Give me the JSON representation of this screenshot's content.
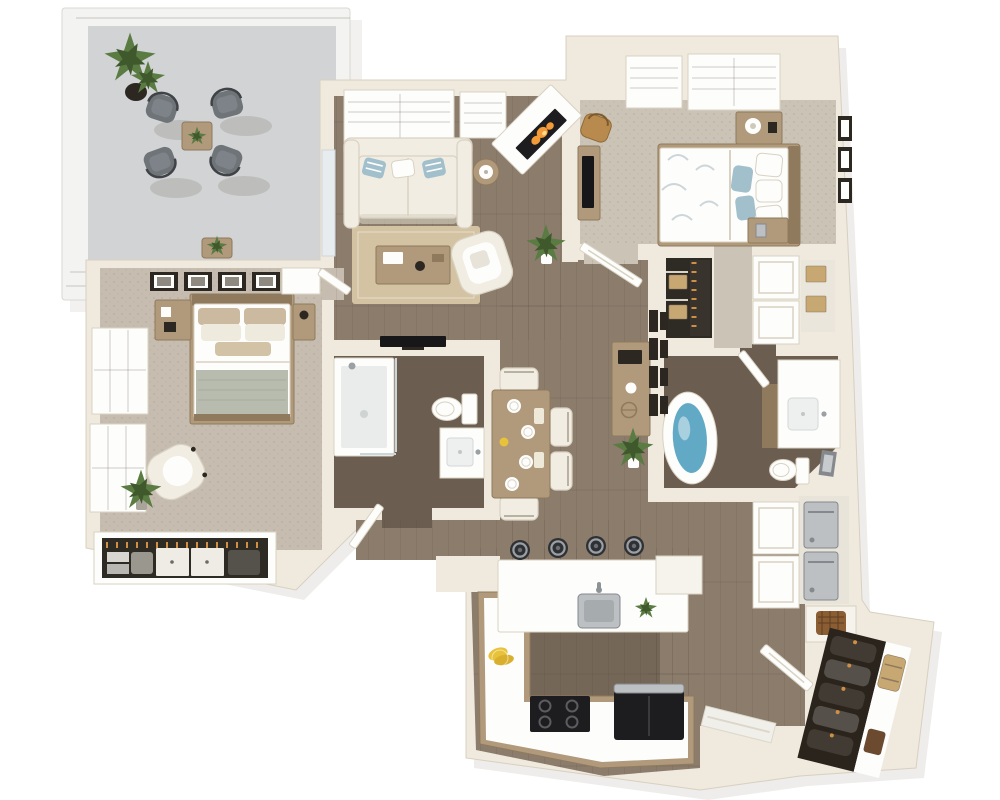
{
  "meta": {
    "description": "3D isometric rendering of a two-bedroom, two-bathroom apartment floor plan with balcony, open living/dining area, kitchen with peninsula, laundry closet and entry closet.",
    "view": "top-down 3D floor plan render",
    "canvas": {
      "width": 1000,
      "height": 800
    }
  },
  "palette": {
    "wall": "#efe9de",
    "wallEdge": "#d8d0bf",
    "railing": "#f3f3f1",
    "railEdge": "#d9d8d3",
    "concrete": "#ced0d1",
    "wood": "#8b7c6c",
    "woodDark": "#746656",
    "bathFloor": "#6b5e50",
    "carpet": "#c6bdb0",
    "carpet2": "#cbc3b6",
    "white": "#fdfdfc",
    "cream": "#f6f3ec",
    "sofa": "#f1ede2",
    "sofaEdge": "#d9d2c2",
    "rug": "#d3c3a2",
    "woodFurn": "#b1997b",
    "woodFurnDark": "#8f7a5d",
    "bluePillow": "#a2bfcc",
    "sage": "#b7bcae",
    "dark": "#2c2721",
    "tv": "#17171a",
    "fire": "#f29b38",
    "green": "#5a7c42",
    "greenDark": "#40592c",
    "steel": "#bcc0c3",
    "steelDark": "#85898d",
    "black": "#1d1d20",
    "tan": "#c7a873",
    "orange": "#cf8f45",
    "water": "#62a9c5",
    "patioChair": "#6f7478",
    "coat": "#413b33",
    "basket": "#8a5d33",
    "glassEdge": "#ccd5d9"
  },
  "semantics": {
    "rooms": [
      {
        "id": "balcony",
        "label": "Balcony patio",
        "floor": "concrete"
      },
      {
        "id": "living-room",
        "label": "Living room",
        "floor": "hardwood"
      },
      {
        "id": "bedroom-2",
        "label": "Bedroom 2",
        "floor": "carpet"
      },
      {
        "id": "master-bedroom",
        "label": "Master bedroom",
        "floor": "carpet"
      },
      {
        "id": "master-bathroom",
        "label": "Bathroom 1 (shower)",
        "floor": "dark wood"
      },
      {
        "id": "bathroom-2",
        "label": "Bathroom 2 (tub)",
        "floor": "dark wood"
      },
      {
        "id": "dining-hall",
        "label": "Dining area / hallway",
        "floor": "hardwood"
      },
      {
        "id": "kitchen",
        "label": "Kitchen",
        "floor": "hardwood"
      },
      {
        "id": "walk-in-closet",
        "label": "Walk-in closet",
        "floor": "dark"
      },
      {
        "id": "laundry-closet",
        "label": "Laundry closet",
        "floor": "hardwood"
      },
      {
        "id": "entry",
        "label": "Entry with coat closet",
        "floor": "hardwood"
      }
    ],
    "furniture": {
      "balcony": [
        "4 gray patio chairs",
        "wood side table with plant",
        "tall potted plant",
        "plant stand"
      ],
      "living-room": [
        "white sofa with blue striped pillows",
        "jute area rug",
        "wood coffee table",
        "white accent chair",
        "round side table with lamp",
        "corner fireplace with fire",
        "wall TV",
        "floor plant"
      ],
      "bedroom-2": [
        "queen bed with floral duvet and blue pillows",
        "headboard",
        "2 nightstands with lamps",
        "desk with TV",
        "wood chair",
        "3 wall frames",
        "double-door closet",
        "shelf closet with boxes"
      ],
      "master-bedroom": [
        "queen bed with sage throw",
        "2 nightstands",
        "4 picture frames",
        "white dresser",
        "cream swivel chair",
        "potted plant",
        "open closet with clothes and drawer units"
      ],
      "master-bathroom": [
        "glass shower",
        "toilet",
        "single vanity"
      ],
      "bathroom-2": [
        "freestanding oval tub",
        "toilet",
        "vanity with sink",
        "leaning frame"
      ],
      "dining-hall": [
        "dining table with 4 place settings and flowers",
        "4 chairs",
        "wood sideboard with decor",
        "gallery wall of 8 frames",
        "floor plant"
      ],
      "kitchen": [
        "white peninsula with stainless sink",
        "4 bar stools",
        "L-shaped counter",
        "black cooktop",
        "black refrigerator",
        "bananas",
        "counter plant"
      ],
      "laundry-closet": [
        "stacked washer and dryer",
        "white double doors",
        "basket niche"
      ],
      "entry": [
        "open entry door",
        "coat closet with hanging coats",
        "suitcase",
        "bag"
      ]
    },
    "counts": {
      "patio_chairs": 4,
      "bar_stools": 4,
      "dining_plates": 4,
      "master_wall_frames": 4,
      "bedroom2_wall_frames": 3,
      "gallery_frames": 8,
      "coats": 5
    }
  }
}
